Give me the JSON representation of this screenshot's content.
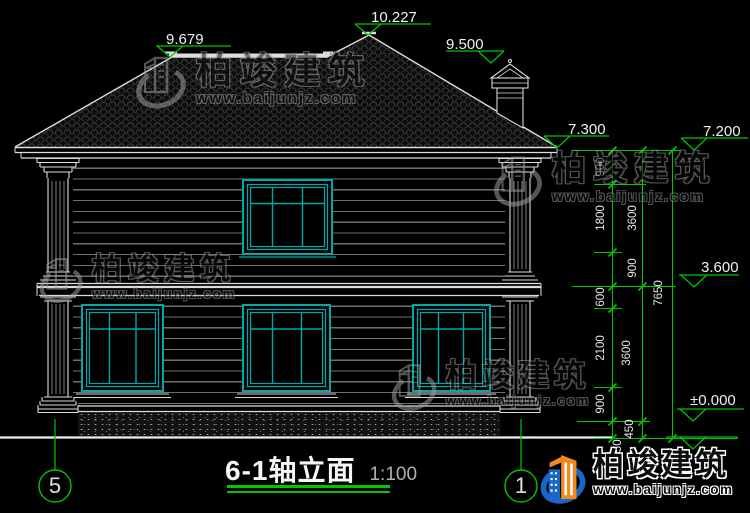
{
  "colors": {
    "background": "#000000",
    "linework": "#dcdcdc",
    "window_frame": "#00a8a8",
    "annotation_green": "#00c800",
    "dimension_text": "#f0f0f0",
    "watermark_gray": "#9c9c9c",
    "logo_blue": "#1966c8",
    "logo_orange": "#f08a1e"
  },
  "elevation_markers": {
    "front_ridge": "9.679",
    "main_ridge": "10.227",
    "chimney_top": "9.500",
    "gutter_top": "7.300",
    "eave_soffit": "7.200",
    "second_floor": "3.600",
    "ground_floor": "±0.000"
  },
  "dimensions": {
    "detail_chain": [
      "900",
      "1800",
      "900",
      "600",
      "2100",
      "900",
      "450"
    ],
    "storey_chain": [
      "3600",
      "3600",
      "450"
    ],
    "overall_chain": [
      "7650"
    ]
  },
  "axis_bubbles": {
    "left": "5",
    "right": "1"
  },
  "title": {
    "text": "6-1轴立面",
    "scale": "1:100"
  },
  "watermark": {
    "brand": "柏竣建筑",
    "url": "www.baijunjz.com"
  },
  "logo": {
    "brand": "柏竣建筑",
    "url": "www.baijunjz.com"
  }
}
